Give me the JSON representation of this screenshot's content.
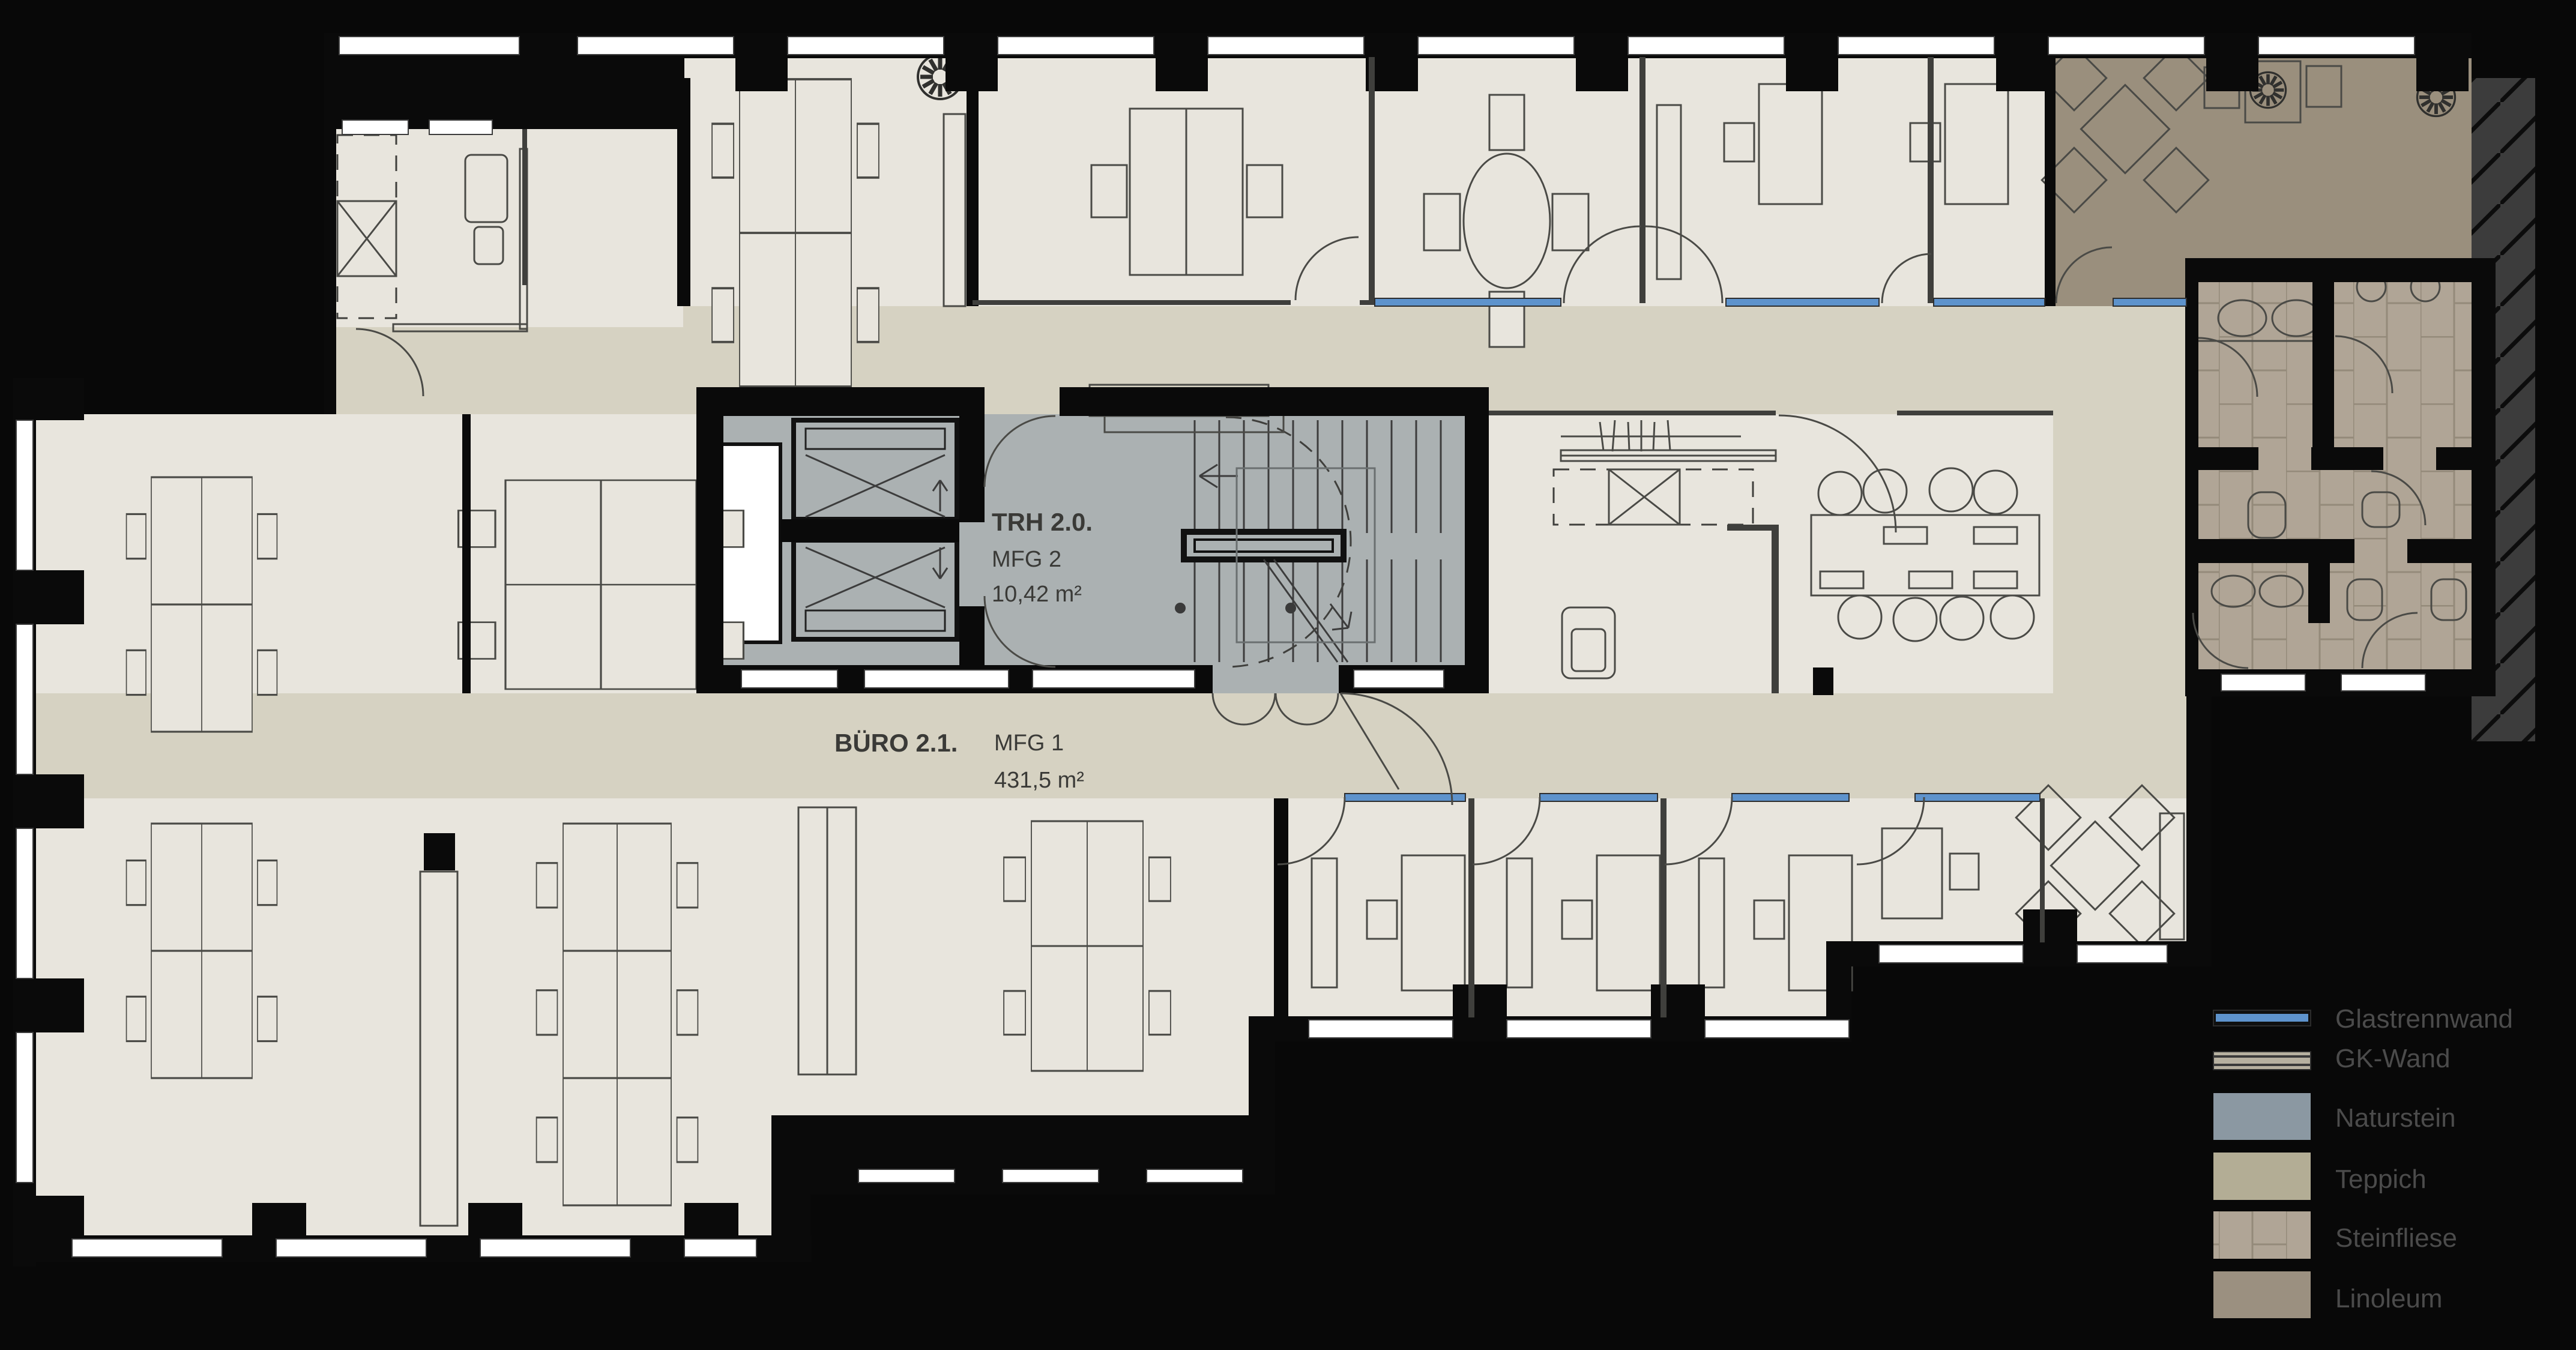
{
  "plan": {
    "rooms": {
      "stairwell": {
        "name": "TRH 2.0.",
        "unit": "MFG 2",
        "area": "10,42 m²"
      },
      "office": {
        "name": "BÜRO 2.1.",
        "unit": "MFG 1",
        "area": "431,5 m²"
      }
    },
    "legend": {
      "items": [
        {
          "label": "Glastrennwand",
          "color": "#5e93cc",
          "swatch": "glass-line"
        },
        {
          "label": "GK-Wand",
          "color": "#b6b0a0",
          "swatch": "striped-wall"
        },
        {
          "label": "Naturstein",
          "color": "#8b98a2",
          "swatch": "solid"
        },
        {
          "label": "Teppich",
          "color": "#b3ad95",
          "swatch": "solid"
        },
        {
          "label": "Steinfliese",
          "color": "#9d9281",
          "swatch": "tiled"
        },
        {
          "label": "Linoleum",
          "color": "#9b9080",
          "swatch": "solid"
        }
      ]
    },
    "colors": {
      "background": "#080808",
      "floor_light": "#e8e5dd",
      "floor_corridor": "#d6d2c2",
      "floor_stone": "#abb1b2",
      "floor_linoleum": "#9a8f7d",
      "floor_tile": "#b0a596",
      "glass": "#5e93cc"
    },
    "icons": {
      "plant": "plant-icon",
      "elevator": "elevator-icon",
      "shaft": "shaft-icon",
      "stair": "stair-icon"
    }
  }
}
